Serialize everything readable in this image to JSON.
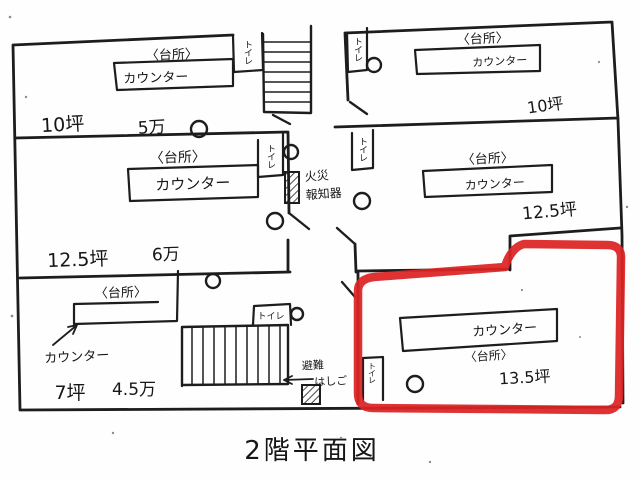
{
  "caption": "2階平面図",
  "colors": {
    "ink": "#1d1d1d",
    "highlight": "#dd2323",
    "paper": "#fefefe"
  },
  "rooms": [
    {
      "name": "top-left",
      "kitchen": "〈台所〉",
      "counter": "カウンター",
      "area": "10坪",
      "rent": "5万"
    },
    {
      "name": "middle-left",
      "kitchen": "〈台所〉",
      "counter": "カウンター",
      "area": "12.5坪",
      "rent": "6万"
    },
    {
      "name": "bottom-left",
      "kitchen": "〈台所〉",
      "counter": "カウンター",
      "area": "7坪",
      "rent": "4.5万"
    },
    {
      "name": "top-right",
      "kitchen": "〈台所〉",
      "counter": "カウンター",
      "area": "10坪"
    },
    {
      "name": "middle-right",
      "kitchen": "〈台所〉",
      "counter": "カウンター",
      "area": "12.5坪"
    },
    {
      "name": "bottom-right",
      "kitchen": "〈台所〉",
      "counter": "カウンター",
      "area": "13.5坪",
      "highlighted": true
    }
  ],
  "fixtures": {
    "toilet": "トイレ",
    "fire_alarm_line1": "火災",
    "fire_alarm_line2": "報知器",
    "evac_ladder_line1": "避難",
    "evac_ladder_line2": "はしご"
  }
}
